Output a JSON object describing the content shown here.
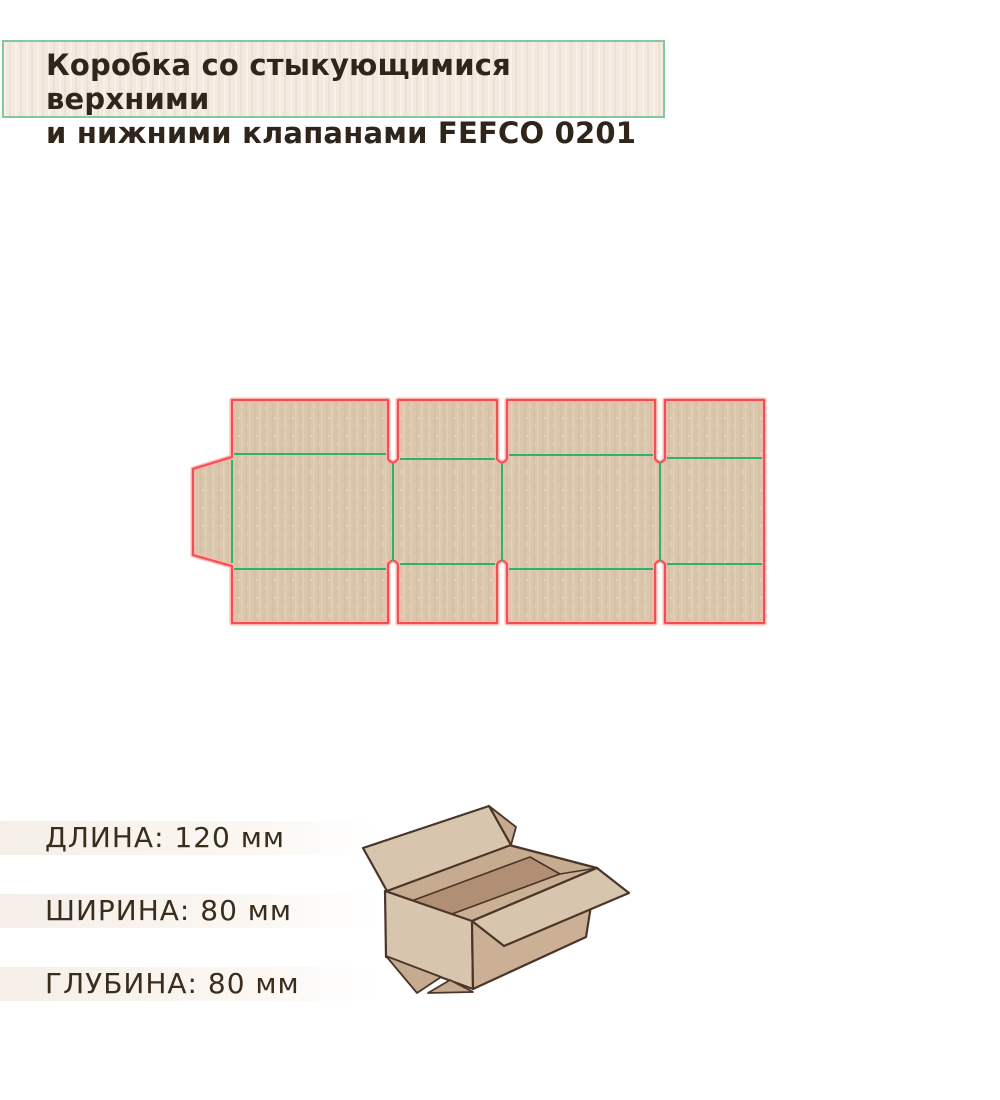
{
  "title": {
    "line1": "Коробка со стыкующимися верхними",
    "line2": "и нижними клапанами FEFCO 0201"
  },
  "dimensions": [
    {
      "label": "ДЛИНА",
      "value": "120",
      "unit": "мм",
      "text": "ДЛИНА: 120 мм"
    },
    {
      "label": "ШИРИНА",
      "value": "80",
      "unit": "мм",
      "text": "ШИРИНА: 80 мм"
    },
    {
      "label": "ГЛУБИНА",
      "value": "80",
      "unit": "мм",
      "text": "ГЛУБИНА: 80 мм"
    }
  ],
  "figures": {
    "dieline": "fefco-0201-dieline-diagram",
    "box3d": "open-cardboard-box-illustration"
  },
  "colors": {
    "cut_line": "#f24f52",
    "cut_halo": "#ffb4ae",
    "fold_line": "#2fb26d",
    "cardboard": "#d9c6ab",
    "cardboard_stripe_dark": "#d1bd9f",
    "cardboard_stripe_light": "#e4d3ba",
    "title_border": "#82c9a1",
    "title_bg": "#f4e9de",
    "title_text": "#2f251a",
    "dim_text": "#3b2d1c",
    "box_outline": "#4a3629",
    "box_light": "#d8c5ae",
    "box_mid": "#c7ab90",
    "box_mid2": "#cbb096",
    "box_dark": "#b08f74"
  }
}
